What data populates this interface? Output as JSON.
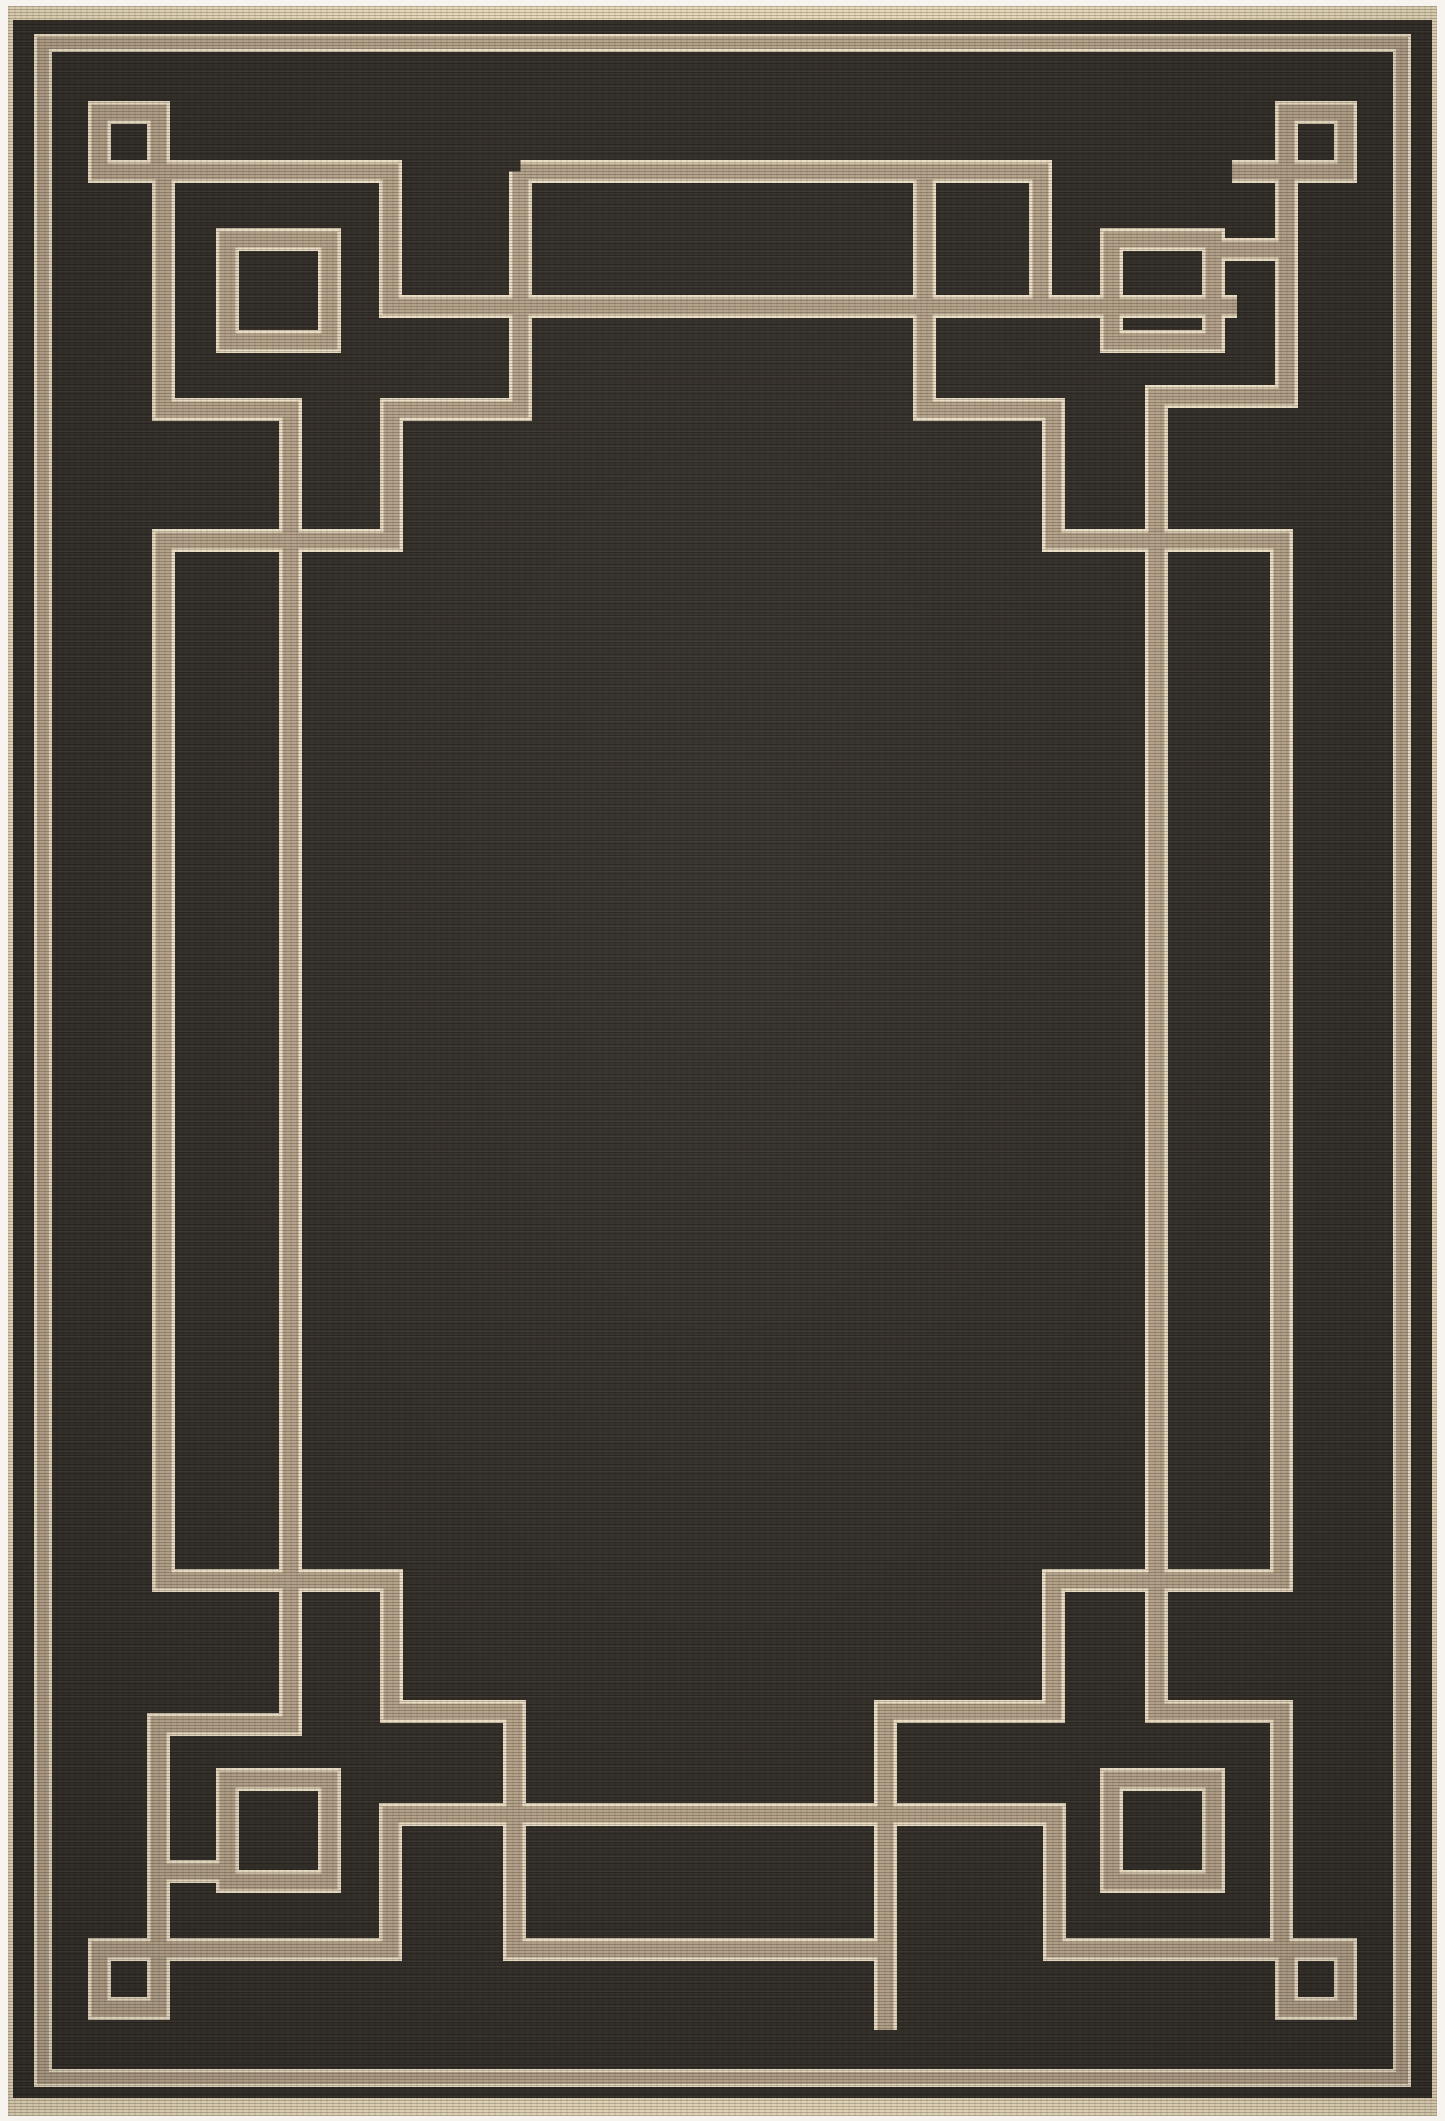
{
  "scene": {
    "width": 1445,
    "height": 2121,
    "background_color": "#f7f4ef"
  },
  "rug": {
    "x": 8,
    "y": 6,
    "width": 1429,
    "height": 2110,
    "binding_color": "#e8d9ba",
    "field_color": "#35302a",
    "field_inset": {
      "left": 5,
      "right": 5,
      "top": 14,
      "bottom": 18
    }
  },
  "pattern": {
    "tan_color": "#b5a28a",
    "cream_color": "#ecdfc5",
    "band_outer_width": 23,
    "band_inner_width": 16,
    "border_outer_width": 18,
    "border_inner_width": 12,
    "outlines": [
      {
        "name": "outer-border-frame",
        "x": 43,
        "y": 43,
        "w": 1359,
        "h": 2035,
        "kind": "border"
      },
      {
        "name": "corner-square-tl",
        "x": 99.5,
        "y": 112.5,
        "w": 59,
        "h": 59,
        "kind": "band"
      },
      {
        "name": "corner-square-tr",
        "x": 1286.5,
        "y": 112.5,
        "w": 59,
        "h": 59,
        "kind": "band"
      },
      {
        "name": "corner-square-bl",
        "x": 99.5,
        "y": 1949.5,
        "w": 59,
        "h": 59,
        "kind": "band"
      },
      {
        "name": "corner-square-br",
        "x": 1286.5,
        "y": 1949.5,
        "w": 59,
        "h": 59,
        "kind": "band"
      },
      {
        "name": "ring-motif-tl",
        "x": 227.5,
        "y": 239.5,
        "w": 102,
        "h": 102,
        "kind": "band"
      },
      {
        "name": "ring-motif-tr",
        "x": 1111.5,
        "y": 239.5,
        "w": 102,
        "h": 102,
        "kind": "band"
      },
      {
        "name": "ring-motif-bl",
        "x": 227.5,
        "y": 1779.5,
        "w": 102,
        "h": 102,
        "kind": "band"
      },
      {
        "name": "ring-motif-br",
        "x": 1111.5,
        "y": 1779.5,
        "w": 102,
        "h": 102,
        "kind": "band"
      }
    ],
    "paths": [
      {
        "name": "fret-top-left-long",
        "points": [
          [
            99.5,
            171.5
          ],
          [
            390.5,
            171.5
          ],
          [
            390.5,
            306.5
          ],
          [
            1237,
            306.5
          ]
        ]
      },
      {
        "name": "fret-top-bar",
        "points": [
          [
            520.5,
            171.5
          ],
          [
            1040.5,
            171.5
          ],
          [
            1040.5,
            306.5
          ]
        ]
      },
      {
        "name": "square-tail-tr",
        "points": [
          [
            1232,
            171.5
          ],
          [
            1345.5,
            171.5
          ]
        ]
      },
      {
        "name": "ring-stub-tr",
        "points": [
          [
            1213,
            249.5
          ],
          [
            1286.5,
            249.5
          ]
        ]
      },
      {
        "name": "ring-stub-bl",
        "points": [
          [
            158.5,
            1871.5
          ],
          [
            232,
            1871.5
          ]
        ]
      },
      {
        "name": "fret-left-interlock",
        "points": [
          [
            520.5,
            171.5
          ],
          [
            520.5,
            409.5
          ],
          [
            391.5,
            409.5
          ],
          [
            391.5,
            540.5
          ],
          [
            163.5,
            540.5
          ],
          [
            163.5,
            1580.5
          ],
          [
            391.5,
            1580.5
          ],
          [
            391.5,
            1711.5
          ],
          [
            514.5,
            1711.5
          ],
          [
            514.5,
            1949.5
          ],
          [
            885.5,
            1949.5
          ],
          [
            885.5,
            2030
          ]
        ]
      },
      {
        "name": "fret-left-rail",
        "points": [
          [
            163.5,
            171.5
          ],
          [
            163.5,
            409.5
          ],
          [
            290.5,
            409.5
          ],
          [
            290.5,
            1724.5
          ],
          [
            158.5,
            1724.5
          ],
          [
            158.5,
            1949.5
          ]
        ]
      },
      {
        "name": "fret-right-interlock",
        "points": [
          [
            924.5,
            171.5
          ],
          [
            924.5,
            409.5
          ],
          [
            1053.5,
            409.5
          ],
          [
            1053.5,
            540.5
          ],
          [
            1281.5,
            540.5
          ],
          [
            1281.5,
            1580.5
          ],
          [
            1053.5,
            1580.5
          ],
          [
            1053.5,
            1711.5
          ],
          [
            885.5,
            1711.5
          ],
          [
            885.5,
            1955
          ]
        ]
      },
      {
        "name": "fret-right-rail",
        "points": [
          [
            1286.5,
            171.5
          ],
          [
            1286.5,
            396.5
          ],
          [
            1156.5,
            396.5
          ],
          [
            1156.5,
            1711.5
          ],
          [
            1281.5,
            1711.5
          ],
          [
            1281.5,
            1949.5
          ]
        ]
      },
      {
        "name": "fret-bottom-long",
        "points": [
          [
            99.5,
            1949.5
          ],
          [
            390.5,
            1949.5
          ],
          [
            390.5,
            1814.5
          ],
          [
            1054.5,
            1814.5
          ],
          [
            1054.5,
            1949.5
          ],
          [
            1345.5,
            1949.5
          ]
        ]
      }
    ]
  }
}
